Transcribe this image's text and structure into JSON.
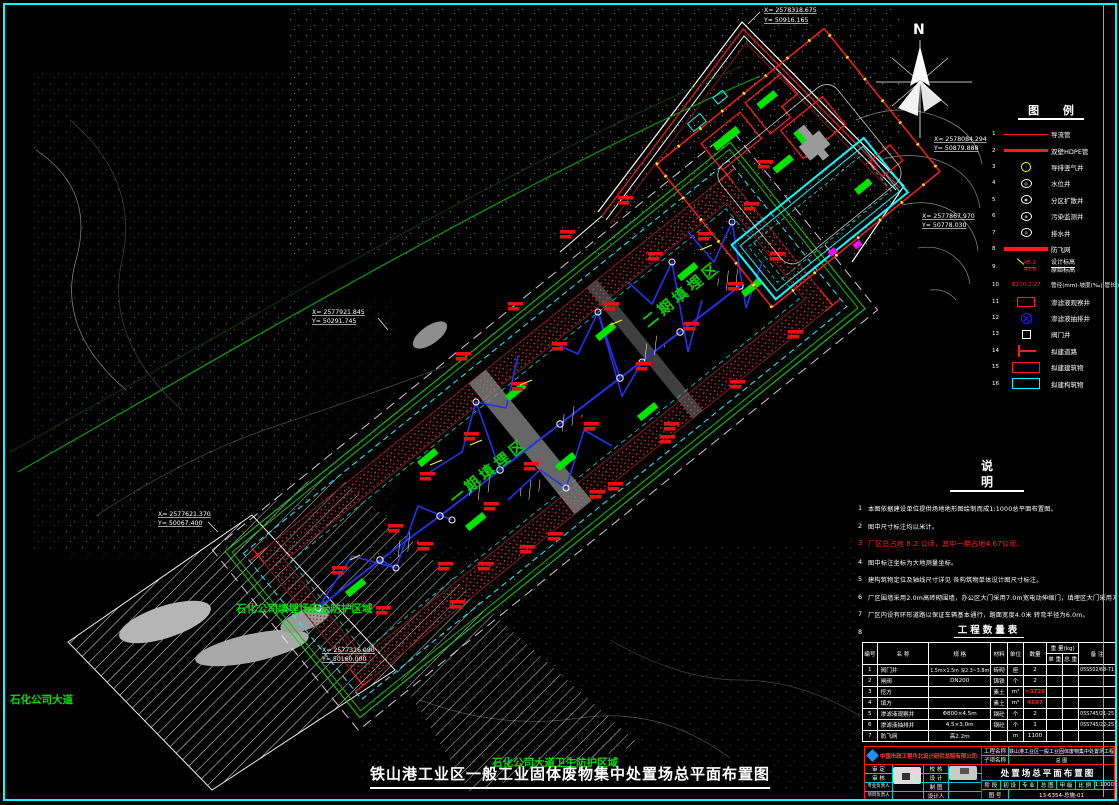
{
  "colors": {
    "accent_cyan": "#00ffff",
    "accent_red": "#ff1a1a",
    "accent_green": "#00e000",
    "pipe_blue": "#2233ee",
    "accent_yellow": "#ffff00"
  },
  "drawing": {
    "main_title": "铁山港工业区一般工业固体废物集中处置场总平面布置图",
    "north": "N",
    "area_labels": [
      "一期填埋区",
      "二期填埋区"
    ],
    "zone_labels": {
      "protect_area": "石化公司填埋场安全防护区域",
      "road_name": "石化公司大道",
      "sanitary_area": "石化公司大道卫生防护区域"
    },
    "callouts": [
      {
        "x": "X= 2578318.675",
        "y": "Y= 50916.165"
      },
      {
        "x": "X= 2578084.294",
        "y": "Y= 50879.888"
      },
      {
        "x": "X= 2577867.970",
        "y": "Y= 50778.030"
      },
      {
        "x": "X= 2577921.845",
        "y": "Y= 50291.745"
      },
      {
        "x": "X= 2577621.370",
        "y": "Y= 50067.400"
      },
      {
        "x": "X= 2577316.090",
        "y": "Y= 50160.000"
      }
    ]
  },
  "legend": {
    "title": "图  例",
    "items": [
      {
        "no": "1",
        "label": "导流管"
      },
      {
        "no": "2",
        "label": "双壁HDPE管"
      },
      {
        "no": "3",
        "label": "导排竖气井"
      },
      {
        "no": "4",
        "label": "水位井"
      },
      {
        "no": "5",
        "label": "分区扩散井"
      },
      {
        "no": "6",
        "label": "污染监测井"
      },
      {
        "no": "7",
        "label": "排水井"
      },
      {
        "no": "8",
        "label": "防飞网"
      },
      {
        "no": "9",
        "label1": "设计标高",
        "label2": "原始标高",
        "sample1": "45.2",
        "sample2": "43.6"
      },
      {
        "no": "10",
        "label": "管径(mm)-坡度(‰)-管长(m)",
        "sample": "Φ200-2-27"
      },
      {
        "no": "11",
        "label": "渗滤液观察井"
      },
      {
        "no": "12",
        "label": "渗滤液抽排井"
      },
      {
        "no": "13",
        "label": "阀门井"
      },
      {
        "no": "14",
        "label": "拟建道路"
      },
      {
        "no": "15",
        "label": "拟建建筑物"
      },
      {
        "no": "16",
        "label": "拟建构筑物"
      }
    ]
  },
  "notes": {
    "title": "说  明",
    "items": [
      {
        "no": "1",
        "text": "本图依据建设单位提供场地地形图绘制而成1:1000总平面布置图。"
      },
      {
        "no": "2",
        "text": "图中尺寸标注均以米计。"
      },
      {
        "no": "3",
        "text": "厂区总占地 8.2 公顷，其中一期占地4.67公顷。"
      },
      {
        "no": "4",
        "text": "图中标注坐标为大地测量坐标。"
      },
      {
        "no": "5",
        "text": "建构筑物定位及轴线尺寸详见 各构筑物单体设计图尺寸标注。"
      },
      {
        "no": "6",
        "text": "厂区围墙采用2.0m高砖砌围墙，办公区大门采用7.0m宽电动伸缩门，填埋区大门采用7m宽平开门。"
      },
      {
        "no": "7",
        "text": "厂区内设有环形道路以保证车辆基本通行，路面宽度4.0米 转弯半径为6.0m。"
      },
      {
        "no": "8",
        "text": "填埋区总库容66.09 万m³ ，使用年限20年。"
      }
    ]
  },
  "quantity_table": {
    "title": "工程数量表",
    "headers": {
      "no": "编号",
      "name": "名    称",
      "spec": "规  格",
      "material": "材料",
      "unit": "单位",
      "qty": "数量",
      "weight": "重 量(kg)",
      "unit_weight": "单 重",
      "total_weight": "总 重",
      "remark": "备    注"
    },
    "rows": [
      {
        "no": "1",
        "name": "阀门井",
        "spec": "1.5m×1.5m 深2.3~3.8m",
        "material": "砖砌",
        "unit": "座",
        "qty": "2",
        "uw": "",
        "tw": "",
        "remark": "05S502/68-71"
      },
      {
        "no": "2",
        "name": "闸阀",
        "spec": "DN200",
        "material": "铸铁",
        "unit": "个",
        "qty": "2",
        "uw": "",
        "tw": "",
        "remark": ""
      },
      {
        "no": "3",
        "name": "挖方",
        "spec": "",
        "material": "素土",
        "unit": "m³",
        "qty": "≈3726",
        "uw": "",
        "tw": "",
        "remark": ""
      },
      {
        "no": "4",
        "name": "填方",
        "spec": "",
        "material": "素土",
        "unit": "m³",
        "qty": "4697",
        "uw": "",
        "tw": "",
        "remark": ""
      },
      {
        "no": "5",
        "name": "渗滤液观察井",
        "spec": "Φ800×4.5m",
        "material": "钢砼",
        "unit": "个",
        "qty": "2",
        "uw": "",
        "tw": "",
        "remark": "05S745/21-25"
      },
      {
        "no": "6",
        "name": "渗滤液抽排井",
        "spec": "4.5×3.0m",
        "material": "钢砼",
        "unit": "个",
        "qty": "1",
        "uw": "",
        "tw": "",
        "remark": "05S745/22-25"
      },
      {
        "no": "7",
        "name": "防飞网",
        "spec": "高2.2m",
        "material": "",
        "unit": "m",
        "qty": "1100",
        "uw": "",
        "tw": "",
        "remark": ""
      }
    ]
  },
  "title_block": {
    "company": "中国市政工程华北设计研究总院有限公司",
    "project_label": "工程名称",
    "project": "铁山港工业区一般工业固体废物集中处置场工程",
    "subitem_label": "子项名称",
    "subitem": "总  图",
    "drawing_title": "处置场总平面布置图",
    "sig_rows": [
      {
        "l": "审 定",
        "m": "校 核"
      },
      {
        "l": "审 核",
        "m": "设 计"
      },
      {
        "l": "专业负责人",
        "m": "制 图"
      },
      {
        "l": "项目负责人",
        "m": "设计人"
      }
    ],
    "stage_label": "阶 段",
    "stage": "初 设",
    "major_label": "专 业",
    "major": "总 图",
    "grade": "甲 级",
    "scale_label": "比 例",
    "scale": "1:1000",
    "no_label": "图 号",
    "drawing_no": "13-6354-总施-01"
  }
}
